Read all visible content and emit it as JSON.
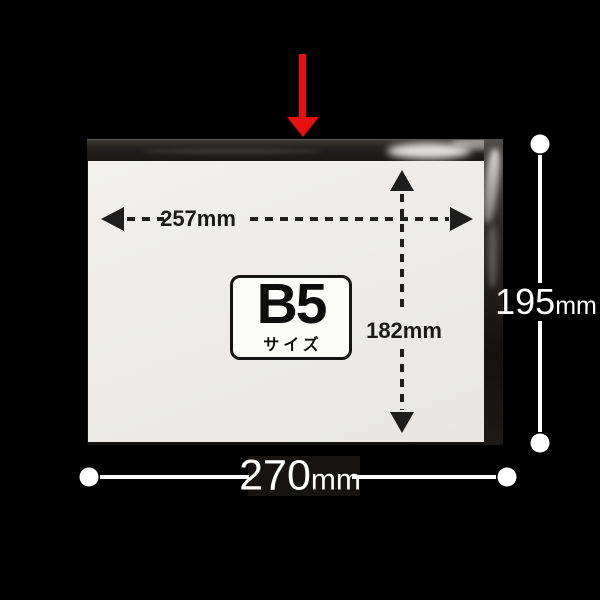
{
  "scene": {
    "description": "product size diagram of clear OPP bag with B5 paper",
    "background_color": "#000000"
  },
  "bag": {
    "label": {
      "size_name": "B5",
      "size_suffix": "サイズ"
    }
  },
  "dimensions": {
    "paper_width": "257mm",
    "paper_height": "182mm",
    "bag_width_value": "270",
    "bag_width_unit": "mm",
    "bag_height_value": "195",
    "bag_height_unit": "mm"
  },
  "colors": {
    "arrow_red": "#e8100c",
    "dimension_dark": "#1e1e1e",
    "dimension_light": "#ffffff",
    "paper": "#ececea",
    "background": "#000000"
  }
}
